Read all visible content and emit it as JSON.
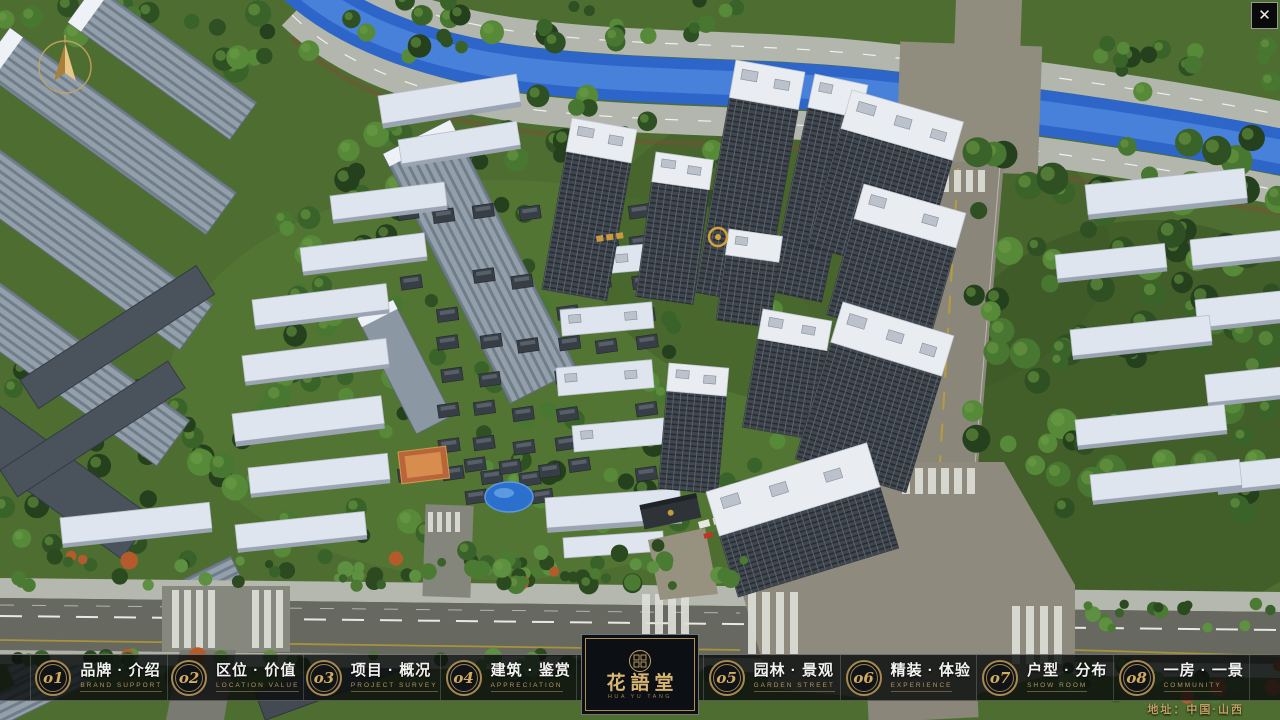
{
  "window": {
    "close_icon": "✕"
  },
  "scene": {
    "address_label": "地址：中国·山西"
  },
  "logo": {
    "title": "花語堂",
    "subtitle": "HUA YU TANG"
  },
  "nav": {
    "items": [
      {
        "num": "o1",
        "zh": "品牌 · 介绍",
        "en": "BRAND SUPPORT"
      },
      {
        "num": "o2",
        "zh": "区位 · 价值",
        "en": "LOCATION VALUE"
      },
      {
        "num": "o3",
        "zh": "项目 · 概况",
        "en": "PROJECT SURVEY"
      },
      {
        "num": "o4",
        "zh": "建筑 · 鉴赏",
        "en": "APPRECIATION"
      },
      {
        "num": "o5",
        "zh": "园林 · 景观",
        "en": "GARDEN STREET"
      },
      {
        "num": "o6",
        "zh": "精装 · 体验",
        "en": "EXPERIENCE"
      },
      {
        "num": "o7",
        "zh": "户型 · 分布",
        "en": "SHOW ROOM"
      },
      {
        "num": "o8",
        "zh": "一房 · 一景",
        "en": "COMMUNITY"
      }
    ]
  },
  "colors": {
    "accent_gold": "#c8a464",
    "bar_background": "rgba(10,13,13,0.83)",
    "chinese_text": "#f2f2f0",
    "river_blue": "#2d66c8"
  }
}
